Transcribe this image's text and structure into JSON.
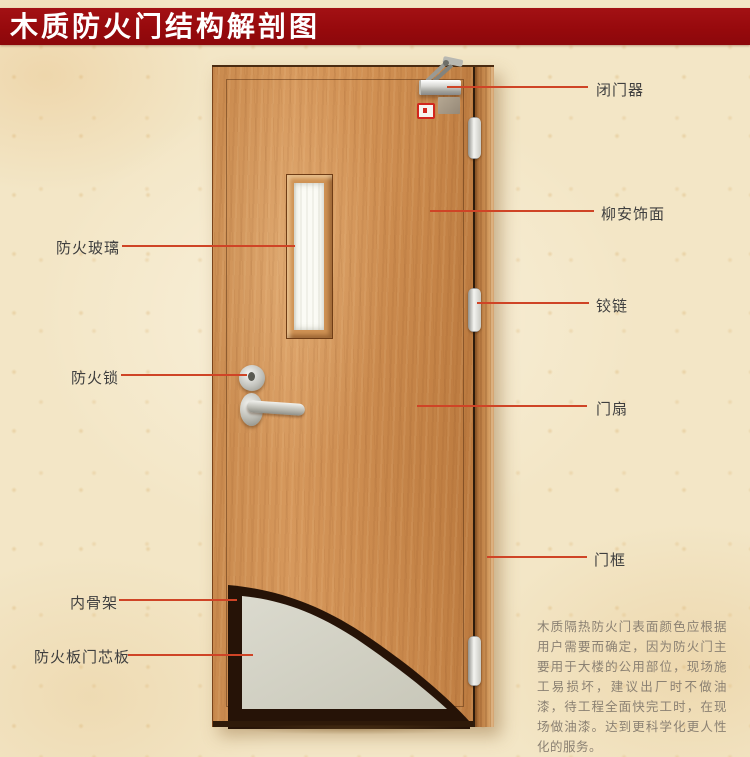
{
  "title": "木质防火门结构解剖图",
  "callouts": {
    "left": [
      {
        "text": "防火玻璃"
      },
      {
        "text": "防火锁"
      },
      {
        "text": "内骨架"
      },
      {
        "text": "防火板门芯板"
      }
    ],
    "right": [
      {
        "text": "闭门器"
      },
      {
        "text": "柳安饰面"
      },
      {
        "text": "铰链"
      },
      {
        "text": "门扇"
      },
      {
        "text": "门框"
      }
    ]
  },
  "description": "木质隔热防火门表面颜色应根据用户需要而确定，因为防火门主要用于大楼的公用部位，现场施工易损坏，建议出厂时不做油漆，待工程全面快完工时，在现场做油漆。达到更科学化更人性化的服务。",
  "colors": {
    "banner_bg": "#96090c",
    "banner_text": "#ffffff",
    "background": "#f3e6c6",
    "callout_line": "#cf4426",
    "label_text": "#3f3f3f",
    "description_text": "#8b8173",
    "door_wood": "#d29255",
    "frame_wood": "#bb7c42",
    "core_gray": "#d4d3c6",
    "skeleton_dark": "#261307"
  }
}
